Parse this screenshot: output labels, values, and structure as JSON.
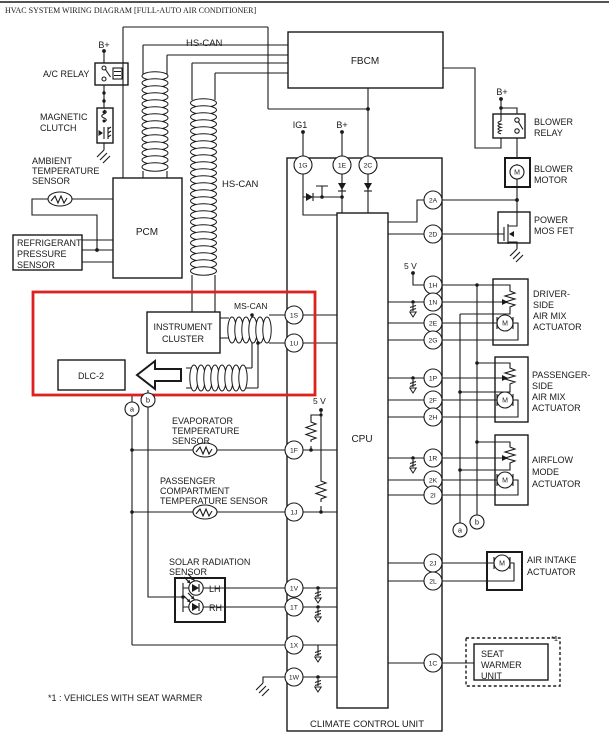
{
  "title": "HVAC SYSTEM WIRING DIAGRAM [FULL-AUTO AIR CONDITIONER]",
  "footnote": "*1 : VEHICLES WITH SEAT WARMER",
  "seat_warmer_ref": "*1",
  "bus_labels": {
    "hs_can_top": "HS-CAN",
    "hs_can_mid": "HS-CAN",
    "ms_can": "MS-CAN"
  },
  "power_labels": {
    "b_plus_ac_relay": "B+",
    "b_plus_climate": "B+",
    "b_plus_blower": "B+",
    "ig1": "IG1",
    "v5_left": "5 V",
    "v5_right": "5 V"
  },
  "modules": {
    "fbcm": "FBCM",
    "pcm": "PCM",
    "dlc2": "DLC-2",
    "cpu": "CPU",
    "instrument_cluster": [
      "INSTRUMENT",
      "CLUSTER"
    ],
    "climate_control_unit": "CLIMATE CONTROL UNIT",
    "seat_warmer_unit": [
      "SEAT",
      "WARMER",
      "UNIT"
    ]
  },
  "left_components": {
    "ac_relay": "A/C RELAY",
    "magnetic_clutch": [
      "MAGNETIC",
      "CLUTCH"
    ],
    "ambient_temp_sensor": [
      "AMBIENT",
      "TEMPERATURE",
      "SENSOR"
    ],
    "refrigerant_pressure_sensor": [
      "REFRIGERANT",
      "PRESSURE",
      "SENSOR"
    ],
    "evaporator_temp_sensor": [
      "EVAPORATOR",
      "TEMPERATURE",
      "SENSOR"
    ],
    "passenger_compartment_temp_sensor": [
      "PASSENGER",
      "COMPARTMENT",
      "TEMPERATURE SENSOR"
    ],
    "solar_radiation_sensor": [
      "SOLAR RADIATION",
      "SENSOR"
    ],
    "solar_lh": "LH",
    "solar_rh": "RH"
  },
  "right_components": {
    "blower_relay": [
      "BLOWER",
      "RELAY"
    ],
    "blower_motor": [
      "BLOWER",
      "MOTOR"
    ],
    "power_mos_fet": [
      "POWER",
      "MOS FET"
    ],
    "driver_side_air_mix_actuator": [
      "DRIVER-",
      "SIDE",
      "AIR MIX",
      "ACTUATOR"
    ],
    "passenger_side_air_mix_actuator": [
      "PASSENGER-",
      "SIDE",
      "AIR MIX",
      "ACTUATOR"
    ],
    "airflow_mode_actuator": [
      "AIRFLOW",
      "MODE",
      "ACTUATOR"
    ],
    "air_intake_actuator": [
      "AIR INTAKE",
      "ACTUATOR"
    ]
  },
  "terminals": {
    "left": [
      "1S",
      "1U",
      "1F",
      "1J",
      "1V",
      "1T",
      "1X",
      "1W"
    ],
    "top": [
      "1G",
      "1E",
      "2C"
    ],
    "right": [
      "2A",
      "2D",
      "1H",
      "1N",
      "2E",
      "2G",
      "1P",
      "2F",
      "2H",
      "1R",
      "2K",
      "2I",
      "2J",
      "2L",
      "1C"
    ],
    "connector_refs": [
      "a",
      "b"
    ]
  },
  "symbols": {
    "motor": "M"
  },
  "colors": {
    "line": "#1a1a1a",
    "highlight": "#dd2020",
    "background": "#ffffff"
  }
}
